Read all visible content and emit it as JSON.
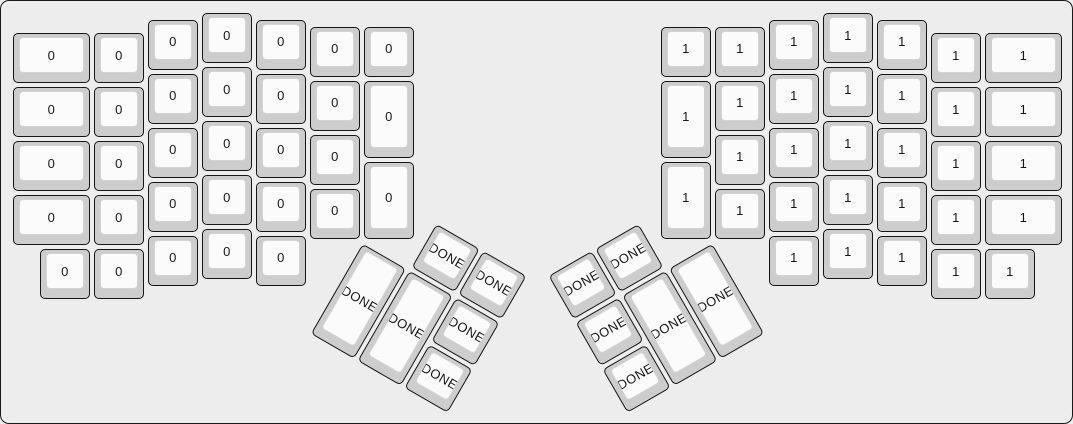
{
  "app": {
    "description": "Split ergonomic (ErgoDox-style) keyboard layout preview",
    "colors": {
      "background": "#ededed",
      "frame_border": "#1a1a1a",
      "keycap_base": "#cdcdcd",
      "keycap_outline": "#151515",
      "keycap_face": "#fbfbfb",
      "keycap_face_border": "#d3d3d3",
      "legend": "#161616"
    }
  },
  "keyboard": {
    "unit_px": 54,
    "key_margin_px": 2,
    "origin": {
      "x": 10,
      "y": 10
    },
    "groups": [
      {
        "name": "left-hand",
        "rotation": 0,
        "pivot": {
          "x": 0,
          "y": 0
        },
        "keys": [
          {
            "x": 0,
            "y": 0.375,
            "w": 1.5,
            "h": 1,
            "label": "0"
          },
          {
            "x": 1.5,
            "y": 0.375,
            "w": 1,
            "h": 1,
            "label": "0"
          },
          {
            "x": 2.5,
            "y": 0.125,
            "w": 1,
            "h": 1,
            "label": "0"
          },
          {
            "x": 3.5,
            "y": 0,
            "w": 1,
            "h": 1,
            "label": "0"
          },
          {
            "x": 4.5,
            "y": 0.125,
            "w": 1,
            "h": 1,
            "label": "0"
          },
          {
            "x": 5.5,
            "y": 0.25,
            "w": 1,
            "h": 1,
            "label": "0"
          },
          {
            "x": 6.5,
            "y": 0.25,
            "w": 1,
            "h": 1,
            "label": "0"
          },
          {
            "x": 0,
            "y": 1.375,
            "w": 1.5,
            "h": 1,
            "label": "0"
          },
          {
            "x": 1.5,
            "y": 1.375,
            "w": 1,
            "h": 1,
            "label": "0"
          },
          {
            "x": 2.5,
            "y": 1.125,
            "w": 1,
            "h": 1,
            "label": "0"
          },
          {
            "x": 3.5,
            "y": 1,
            "w": 1,
            "h": 1,
            "label": "0"
          },
          {
            "x": 4.5,
            "y": 1.125,
            "w": 1,
            "h": 1,
            "label": "0"
          },
          {
            "x": 5.5,
            "y": 1.25,
            "w": 1,
            "h": 1,
            "label": "0"
          },
          {
            "x": 6.5,
            "y": 1.25,
            "w": 1,
            "h": 1.5,
            "label": "0"
          },
          {
            "x": 0,
            "y": 2.375,
            "w": 1.5,
            "h": 1,
            "label": "0"
          },
          {
            "x": 1.5,
            "y": 2.375,
            "w": 1,
            "h": 1,
            "label": "0"
          },
          {
            "x": 2.5,
            "y": 2.125,
            "w": 1,
            "h": 1,
            "label": "0"
          },
          {
            "x": 3.5,
            "y": 2,
            "w": 1,
            "h": 1,
            "label": "0"
          },
          {
            "x": 4.5,
            "y": 2.125,
            "w": 1,
            "h": 1,
            "label": "0"
          },
          {
            "x": 5.5,
            "y": 2.25,
            "w": 1,
            "h": 1,
            "label": "0"
          },
          {
            "x": 6.5,
            "y": 2.75,
            "w": 1,
            "h": 1.5,
            "label": "0"
          },
          {
            "x": 0,
            "y": 3.375,
            "w": 1.5,
            "h": 1,
            "label": "0"
          },
          {
            "x": 1.5,
            "y": 3.375,
            "w": 1,
            "h": 1,
            "label": "0"
          },
          {
            "x": 2.5,
            "y": 3.125,
            "w": 1,
            "h": 1,
            "label": "0"
          },
          {
            "x": 3.5,
            "y": 3,
            "w": 1,
            "h": 1,
            "label": "0"
          },
          {
            "x": 4.5,
            "y": 3.125,
            "w": 1,
            "h": 1,
            "label": "0"
          },
          {
            "x": 5.5,
            "y": 3.25,
            "w": 1,
            "h": 1,
            "label": "0"
          },
          {
            "x": 0.5,
            "y": 4.375,
            "w": 1,
            "h": 1,
            "label": "0"
          },
          {
            "x": 1.5,
            "y": 4.375,
            "w": 1,
            "h": 1,
            "label": "0"
          },
          {
            "x": 2.5,
            "y": 4.125,
            "w": 1,
            "h": 1,
            "label": "0"
          },
          {
            "x": 3.5,
            "y": 4,
            "w": 1,
            "h": 1,
            "label": "0"
          },
          {
            "x": 4.5,
            "y": 4.125,
            "w": 1,
            "h": 1,
            "label": "0"
          }
        ]
      },
      {
        "name": "right-hand",
        "rotation": 0,
        "pivot": {
          "x": 0,
          "y": 0
        },
        "keys": [
          {
            "x": 12,
            "y": 0.25,
            "w": 1,
            "h": 1,
            "label": "1"
          },
          {
            "x": 13,
            "y": 0.25,
            "w": 1,
            "h": 1,
            "label": "1"
          },
          {
            "x": 14,
            "y": 0.125,
            "w": 1,
            "h": 1,
            "label": "1"
          },
          {
            "x": 15,
            "y": 0,
            "w": 1,
            "h": 1,
            "label": "1"
          },
          {
            "x": 16,
            "y": 0.125,
            "w": 1,
            "h": 1,
            "label": "1"
          },
          {
            "x": 17,
            "y": 0.375,
            "w": 1,
            "h": 1,
            "label": "1"
          },
          {
            "x": 18,
            "y": 0.375,
            "w": 1.5,
            "h": 1,
            "label": "1"
          },
          {
            "x": 12,
            "y": 1.25,
            "w": 1,
            "h": 1.5,
            "label": "1"
          },
          {
            "x": 13,
            "y": 1.25,
            "w": 1,
            "h": 1,
            "label": "1"
          },
          {
            "x": 14,
            "y": 1.125,
            "w": 1,
            "h": 1,
            "label": "1"
          },
          {
            "x": 15,
            "y": 1,
            "w": 1,
            "h": 1,
            "label": "1"
          },
          {
            "x": 16,
            "y": 1.125,
            "w": 1,
            "h": 1,
            "label": "1"
          },
          {
            "x": 17,
            "y": 1.375,
            "w": 1,
            "h": 1,
            "label": "1"
          },
          {
            "x": 18,
            "y": 1.375,
            "w": 1.5,
            "h": 1,
            "label": "1"
          },
          {
            "x": 12,
            "y": 2.75,
            "w": 1,
            "h": 1.5,
            "label": "1"
          },
          {
            "x": 13,
            "y": 2.25,
            "w": 1,
            "h": 1,
            "label": "1"
          },
          {
            "x": 14,
            "y": 2.125,
            "w": 1,
            "h": 1,
            "label": "1"
          },
          {
            "x": 15,
            "y": 2,
            "w": 1,
            "h": 1,
            "label": "1"
          },
          {
            "x": 16,
            "y": 2.125,
            "w": 1,
            "h": 1,
            "label": "1"
          },
          {
            "x": 17,
            "y": 2.375,
            "w": 1,
            "h": 1,
            "label": "1"
          },
          {
            "x": 18,
            "y": 2.375,
            "w": 1.5,
            "h": 1,
            "label": "1"
          },
          {
            "x": 13,
            "y": 3.25,
            "w": 1,
            "h": 1,
            "label": "1"
          },
          {
            "x": 14,
            "y": 3.125,
            "w": 1,
            "h": 1,
            "label": "1"
          },
          {
            "x": 15,
            "y": 3,
            "w": 1,
            "h": 1,
            "label": "1"
          },
          {
            "x": 16,
            "y": 3.125,
            "w": 1,
            "h": 1,
            "label": "1"
          },
          {
            "x": 17,
            "y": 3.375,
            "w": 1,
            "h": 1,
            "label": "1"
          },
          {
            "x": 18,
            "y": 3.375,
            "w": 1.5,
            "h": 1,
            "label": "1"
          },
          {
            "x": 14,
            "y": 4.125,
            "w": 1,
            "h": 1,
            "label": "1"
          },
          {
            "x": 15,
            "y": 4,
            "w": 1,
            "h": 1,
            "label": "1"
          },
          {
            "x": 16,
            "y": 4.125,
            "w": 1,
            "h": 1,
            "label": "1"
          },
          {
            "x": 17,
            "y": 4.375,
            "w": 1,
            "h": 1,
            "label": "1"
          },
          {
            "x": 18,
            "y": 4.375,
            "w": 1,
            "h": 1,
            "label": "1"
          }
        ]
      },
      {
        "name": "left-thumb-cluster",
        "rotation": 30,
        "pivot": {
          "x": 6.5,
          "y": 4.25
        },
        "keys": [
          {
            "x": 1,
            "y": -1,
            "w": 1,
            "h": 1,
            "label": "DONE"
          },
          {
            "x": 2,
            "y": -1,
            "w": 1,
            "h": 1,
            "label": "DONE"
          },
          {
            "x": 0,
            "y": 0,
            "w": 1,
            "h": 2,
            "label": "DONE"
          },
          {
            "x": 1,
            "y": 0,
            "w": 1,
            "h": 2,
            "label": "DONE"
          },
          {
            "x": 2,
            "y": 0,
            "w": 1,
            "h": 1,
            "label": "DONE"
          },
          {
            "x": 2,
            "y": 1,
            "w": 1,
            "h": 1,
            "label": "DONE"
          }
        ]
      },
      {
        "name": "right-thumb-cluster",
        "rotation": -30,
        "pivot": {
          "x": 13,
          "y": 4.25
        },
        "keys": [
          {
            "x": -3,
            "y": -1,
            "w": 1,
            "h": 1,
            "label": "DONE"
          },
          {
            "x": -2,
            "y": -1,
            "w": 1,
            "h": 1,
            "label": "DONE"
          },
          {
            "x": -3,
            "y": 0,
            "w": 1,
            "h": 1,
            "label": "DONE"
          },
          {
            "x": -2,
            "y": 0,
            "w": 1,
            "h": 2,
            "label": "DONE"
          },
          {
            "x": -1,
            "y": 0,
            "w": 1,
            "h": 2,
            "label": "DONE"
          },
          {
            "x": -3,
            "y": 1,
            "w": 1,
            "h": 1,
            "label": "DONE"
          }
        ]
      }
    ]
  }
}
